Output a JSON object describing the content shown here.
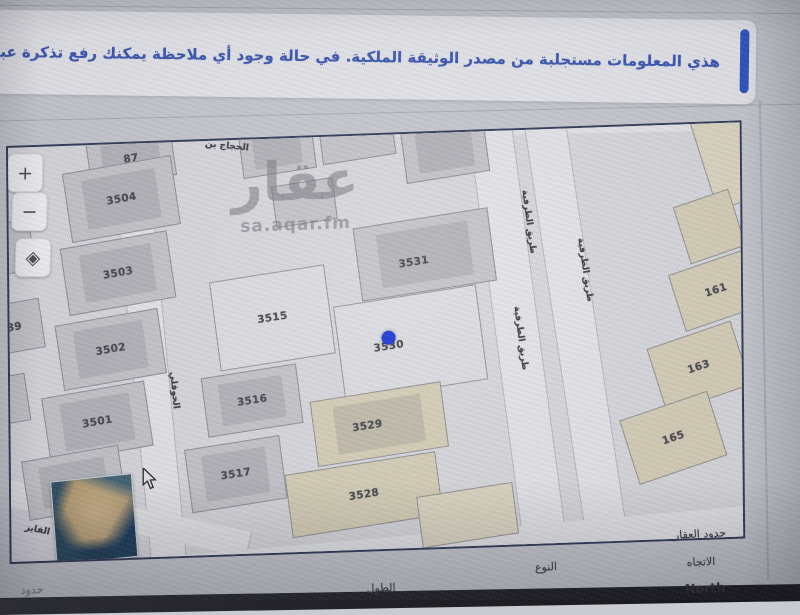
{
  "banner": {
    "text": "هذي المعلومات مستجلبة من مصدر الوثيقة الملكية. في حالة وجود أي ملاحظة يمكنك رفع تذكرة عبر المركز ال",
    "help_icon": "؟",
    "accent_color": "#2b53c2",
    "text_color": "#3a56b2"
  },
  "map": {
    "watermark": {
      "title": "عقار",
      "subtitle": "sa.aqar.fm"
    },
    "controls": [
      {
        "name": "zoom-in-button",
        "glyph": "+",
        "x": -1,
        "y": 6
      },
      {
        "name": "zoom-out-button",
        "glyph": "−",
        "x": 3,
        "y": 45
      },
      {
        "name": "locate-button",
        "glyph": "◈",
        "x": 6,
        "y": 91
      }
    ],
    "marker": {
      "color": "#1c36d8",
      "x": 379,
      "y": 203,
      "parcel": "3530"
    },
    "roads": [
      {
        "x": -20,
        "y": -24,
        "w": 800,
        "h": 26,
        "r": 1
      },
      {
        "x": 122,
        "y": -15,
        "w": 34,
        "h": 470,
        "r": -5
      },
      {
        "x": 488,
        "y": -15,
        "w": 42,
        "h": 470,
        "r": -7
      },
      {
        "x": 548,
        "y": -15,
        "w": 40,
        "h": 470,
        "r": -8
      },
      {
        "x": -40,
        "y": 358,
        "w": 280,
        "h": 26,
        "r": 14
      },
      {
        "x": 150,
        "y": 398,
        "w": 620,
        "h": 30,
        "r": -3
      }
    ],
    "streets": [
      {
        "text": "الحجاج بن",
        "x": 219,
        "y": 6,
        "r": 8,
        "v": false
      },
      {
        "text": "الحوقلي",
        "x": 164,
        "y": 248,
        "r": -5,
        "v": true
      },
      {
        "text": "طريق الطرفية",
        "x": 520,
        "y": 92,
        "r": -7,
        "v": true
      },
      {
        "text": "طريق الطرفية",
        "x": 511,
        "y": 208,
        "r": -7,
        "v": true
      },
      {
        "text": "طريق الطرفية",
        "x": 576,
        "y": 142,
        "r": -8,
        "v": true
      },
      {
        "text": "الفايز",
        "x": 26,
        "y": 383,
        "r": 14,
        "v": false
      }
    ],
    "parcels": [
      {
        "n": "87",
        "x": 122,
        "y": 14,
        "w": 84,
        "h": 46,
        "r": -8,
        "f": "g",
        "b": 1
      },
      {
        "n": "3504",
        "x": 112,
        "y": 54,
        "w": 108,
        "h": 68,
        "r": -8,
        "f": "g",
        "b": 1
      },
      {
        "n": "3503",
        "x": 108,
        "y": 128,
        "w": 106,
        "h": 66,
        "r": -8,
        "f": "g",
        "b": 1
      },
      {
        "n": "3502",
        "x": 100,
        "y": 204,
        "w": 102,
        "h": 64,
        "r": -8,
        "f": "g",
        "b": 1
      },
      {
        "n": "3501",
        "x": 86,
        "y": 276,
        "w": 102,
        "h": 64,
        "r": -8,
        "f": "g",
        "b": 1
      },
      {
        "n": "489",
        "x": 0,
        "y": 179,
        "w": 62,
        "h": 48,
        "r": -8,
        "f": "g",
        "b": 0
      },
      {
        "n": "",
        "x": -8,
        "y": 100,
        "w": 60,
        "h": 50,
        "r": -8,
        "f": "g",
        "b": 0
      },
      {
        "n": "",
        "x": -12,
        "y": 252,
        "w": 56,
        "h": 46,
        "r": -8,
        "f": "g",
        "b": 0
      },
      {
        "n": "",
        "x": 62,
        "y": 336,
        "w": 96,
        "h": 58,
        "r": -8,
        "f": "g",
        "b": 1
      },
      {
        "n": "3515",
        "x": 262,
        "y": 178,
        "w": 114,
        "h": 88,
        "r": -7,
        "f": "l",
        "b": 0
      },
      {
        "n": "3516",
        "x": 241,
        "y": 260,
        "w": 94,
        "h": 58,
        "r": -7,
        "f": "g",
        "b": 1
      },
      {
        "n": "3517",
        "x": 224,
        "y": 333,
        "w": 94,
        "h": 62,
        "r": -7,
        "f": "g",
        "b": 1
      },
      {
        "n": "3531",
        "x": 415,
        "y": 120,
        "w": 134,
        "h": 72,
        "r": -7,
        "f": "g",
        "b": 1,
        "lx": 403,
        "ly": 126
      },
      {
        "n": "3530",
        "x": 400,
        "y": 208,
        "w": 142,
        "h": 94,
        "r": -7,
        "f": "l",
        "b": 0,
        "lx": 378,
        "ly": 208
      },
      {
        "n": "3529",
        "x": 368,
        "y": 288,
        "w": 130,
        "h": 64,
        "r": -7,
        "f": "b",
        "b": 1,
        "lx": 356,
        "ly": 288
      },
      {
        "n": "3528",
        "x": 352,
        "y": 358,
        "w": 150,
        "h": 62,
        "r": -7,
        "f": "b",
        "b": 0
      },
      {
        "n": "",
        "x": 268,
        "y": 8,
        "w": 72,
        "h": 50,
        "r": -7,
        "f": "g",
        "b": 1
      },
      {
        "n": "",
        "x": 348,
        "y": 0,
        "w": 72,
        "h": 44,
        "r": -7,
        "f": "g",
        "b": 0
      },
      {
        "n": "",
        "x": 436,
        "y": 16,
        "w": 82,
        "h": 54,
        "r": -7,
        "f": "g",
        "b": 1
      },
      {
        "n": "",
        "x": 295,
        "y": 64,
        "w": 60,
        "h": 40,
        "r": -7,
        "f": "g",
        "b": 0
      },
      {
        "n": "161",
        "x": 706,
        "y": 166,
        "w": 80,
        "h": 58,
        "r": -17,
        "f": "b",
        "b": 0
      },
      {
        "n": "163",
        "x": 688,
        "y": 242,
        "w": 86,
        "h": 66,
        "r": -17,
        "f": "b",
        "b": 0
      },
      {
        "n": "165",
        "x": 662,
        "y": 312,
        "w": 90,
        "h": 66,
        "r": -17,
        "f": "b",
        "b": 0
      },
      {
        "n": "",
        "x": 726,
        "y": 32,
        "w": 64,
        "h": 92,
        "r": -17,
        "f": "bl",
        "b": 0
      },
      {
        "n": "",
        "x": 700,
        "y": 102,
        "w": 56,
        "h": 58,
        "r": -17,
        "f": "b",
        "b": 0
      },
      {
        "n": "",
        "x": 455,
        "y": 382,
        "w": 95,
        "h": 50,
        "r": -7,
        "f": "bl",
        "b": 0
      }
    ]
  },
  "footer": {
    "labels": [
      {
        "name": "property-borders-label",
        "text": "حدود العقار",
        "x": 700,
        "y": 534,
        "size": 11,
        "bold": false,
        "color": "#3e3e46"
      },
      {
        "name": "direction-label",
        "text": "الاتجاه",
        "x": 701,
        "y": 562,
        "size": 11,
        "bold": false,
        "color": "#3e3e46"
      },
      {
        "name": "direction-value",
        "text": "North",
        "x": 705,
        "y": 588,
        "size": 12.5,
        "bold": true,
        "color": "#2b2b33"
      },
      {
        "name": "type-label",
        "text": "النوع",
        "x": 546,
        "y": 567,
        "size": 11,
        "bold": false,
        "color": "#3e3e46"
      },
      {
        "name": "length-label",
        "text": "الطول",
        "x": 381,
        "y": 588,
        "size": 11,
        "bold": false,
        "color": "#3e3e46"
      },
      {
        "name": "borders-partial-label",
        "text": "حدود",
        "x": 32,
        "y": 590,
        "size": 11,
        "bold": false,
        "color": "#84848c"
      }
    ]
  }
}
